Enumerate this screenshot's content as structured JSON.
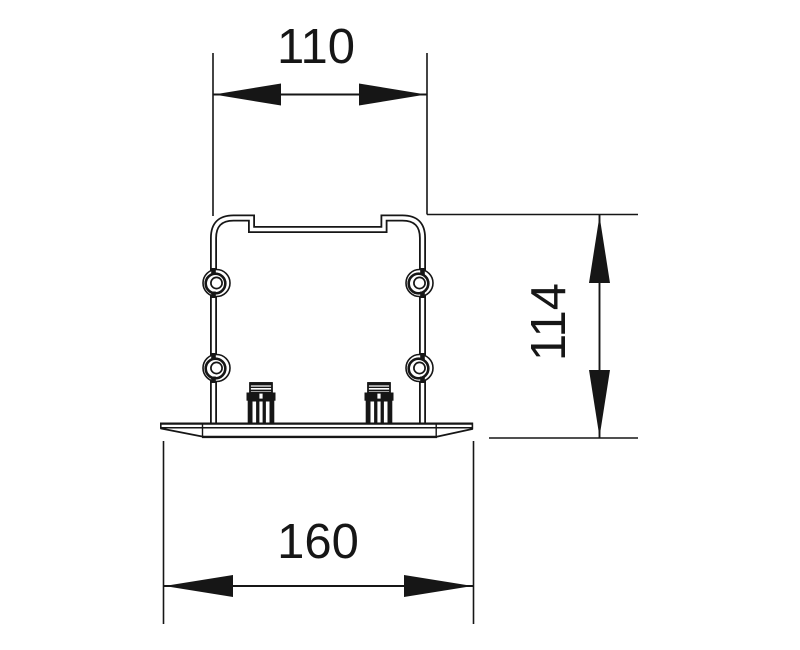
{
  "drawing": {
    "background_color": "#ffffff",
    "line_color": "#161616",
    "dimensions": [
      {
        "id": "top-width",
        "value": "110",
        "orientation": "horizontal",
        "position": "top"
      },
      {
        "id": "side-height",
        "value": "114",
        "orientation": "vertical",
        "position": "right"
      },
      {
        "id": "bottom-width",
        "value": "160",
        "orientation": "horizontal",
        "position": "bottom"
      }
    ],
    "features": {
      "screw_bosses_visible": 4,
      "terminals_on_base_visible": 2
    }
  }
}
